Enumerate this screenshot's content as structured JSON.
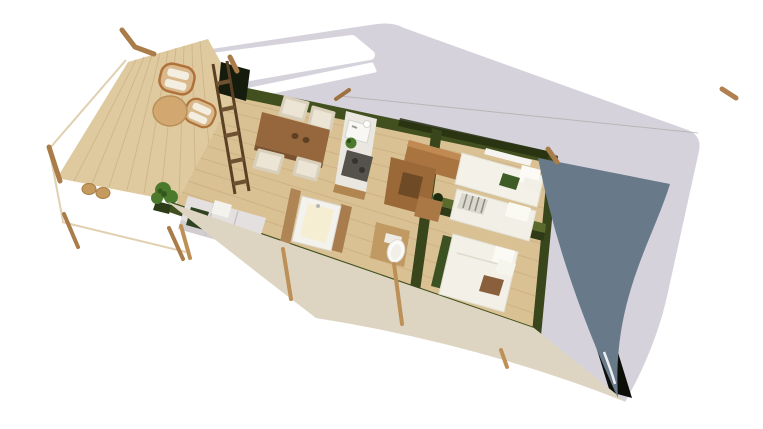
{
  "scene": {
    "type": "3d-architectural-cutaway-render",
    "subject": "Safari glamping tent lodge viewed from above with roof partially removed",
    "orientation": "structure rotated diagonally, deck at left, bedrooms at right",
    "background": "#ffffff",
    "areas": [
      {
        "name": "deck-terrace",
        "items": [
          "lounge chair with white cushion",
          "lounge chair with white cushion",
          "round side table",
          "potted plant",
          "pouf",
          "pouf",
          "timber railing",
          "leaning ladder"
        ]
      },
      {
        "name": "living-dining-area",
        "items": [
          "dining table",
          "4 white dining chairs",
          "sofa with cushions and green throw"
        ]
      },
      {
        "name": "kitchen",
        "items": [
          "counter unit",
          "sink with faucet",
          "cup",
          "herb plant",
          "dark cooktop"
        ]
      },
      {
        "name": "bathroom",
        "items": [
          "square bathtub with cream interior",
          "toilet in timber nook",
          "timber partition walls"
        ]
      },
      {
        "name": "hallway",
        "items": [
          "wardrobe cabinet",
          "L-shaped wardrobe",
          "nightstand"
        ]
      },
      {
        "name": "twin-bedroom",
        "items": [
          "single bed with green pillow",
          "single bed with striped pillow",
          "white window slit in canvas wall"
        ]
      },
      {
        "name": "double-bedroom",
        "items": [
          "double bed with white and tan pillows",
          "green upholstered bench",
          "plant silhouette"
        ]
      }
    ],
    "structure": [
      "grey roof canvas with white roof opening",
      "slate-blue rear canvas sail",
      "beige scalloped front awning",
      "dark green canvas walls",
      "timber poles and posts"
    ]
  },
  "colors": {
    "white": "#ffffff",
    "roof_canvas": "#d5d2dc",
    "roof_opening": "#ffffff",
    "rear_canvas": "#68798a",
    "front_awning": "#ddd5c2",
    "canvas_wall": "#42501f",
    "canvas_wall_dark": "#161c0d",
    "wall_top_light": "#5a6a2c",
    "floor_wood": "#d9c194",
    "floor_plank": "#c5a678",
    "deck_wood": "#dfca9f",
    "deck_plank": "#cdb285",
    "pole_wood": "#a97c4a",
    "post_wood": "#bd9058",
    "furniture_wood": "#a9743f",
    "table_wood": "#96673c",
    "counter_top": "#e9e7e0",
    "cooktop": "#55524c",
    "soft_white": "#f3f1e8",
    "sofa_fabric": "#e4e0df",
    "green_textile": "#3c5122",
    "plant_green": "#4c7a2d",
    "tan_pillow": "#8a5f3c",
    "shadow_dark": "#0c0e08"
  }
}
